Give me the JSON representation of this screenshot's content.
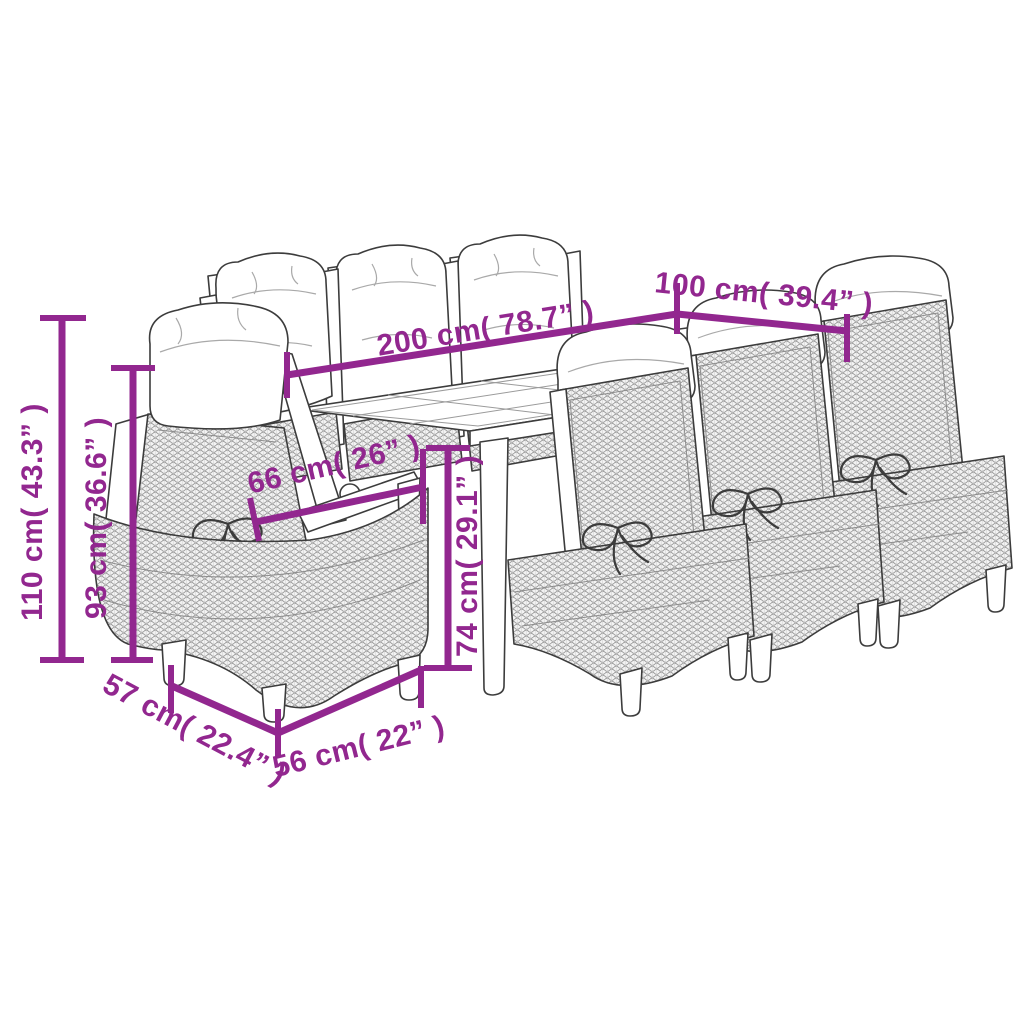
{
  "figure": {
    "kind": "product-dimension-diagram",
    "subject": "garden dining set with table and eight cushioned rattan chairs",
    "colors": {
      "accent": "#92278f",
      "line_art": "#3c3c3c",
      "rattan_texture": "#9a9a9a",
      "background": "#ffffff"
    }
  },
  "dimensions": {
    "table_length": {
      "label": "200 cm( 78.7” )"
    },
    "table_width": {
      "label": "100 cm( 39.4” )"
    },
    "chair_height": {
      "label": "110 cm( 43.3” )"
    },
    "back_height": {
      "label": "93 cm( 36.6” )"
    },
    "chair_depth_total": {
      "label": "66 cm( 26” )"
    },
    "table_height": {
      "label": "74 cm( 29.1” )"
    },
    "seat_depth": {
      "label": "57 cm( 22.4” )"
    },
    "chair_width": {
      "label": "56 cm( 22” )"
    }
  }
}
